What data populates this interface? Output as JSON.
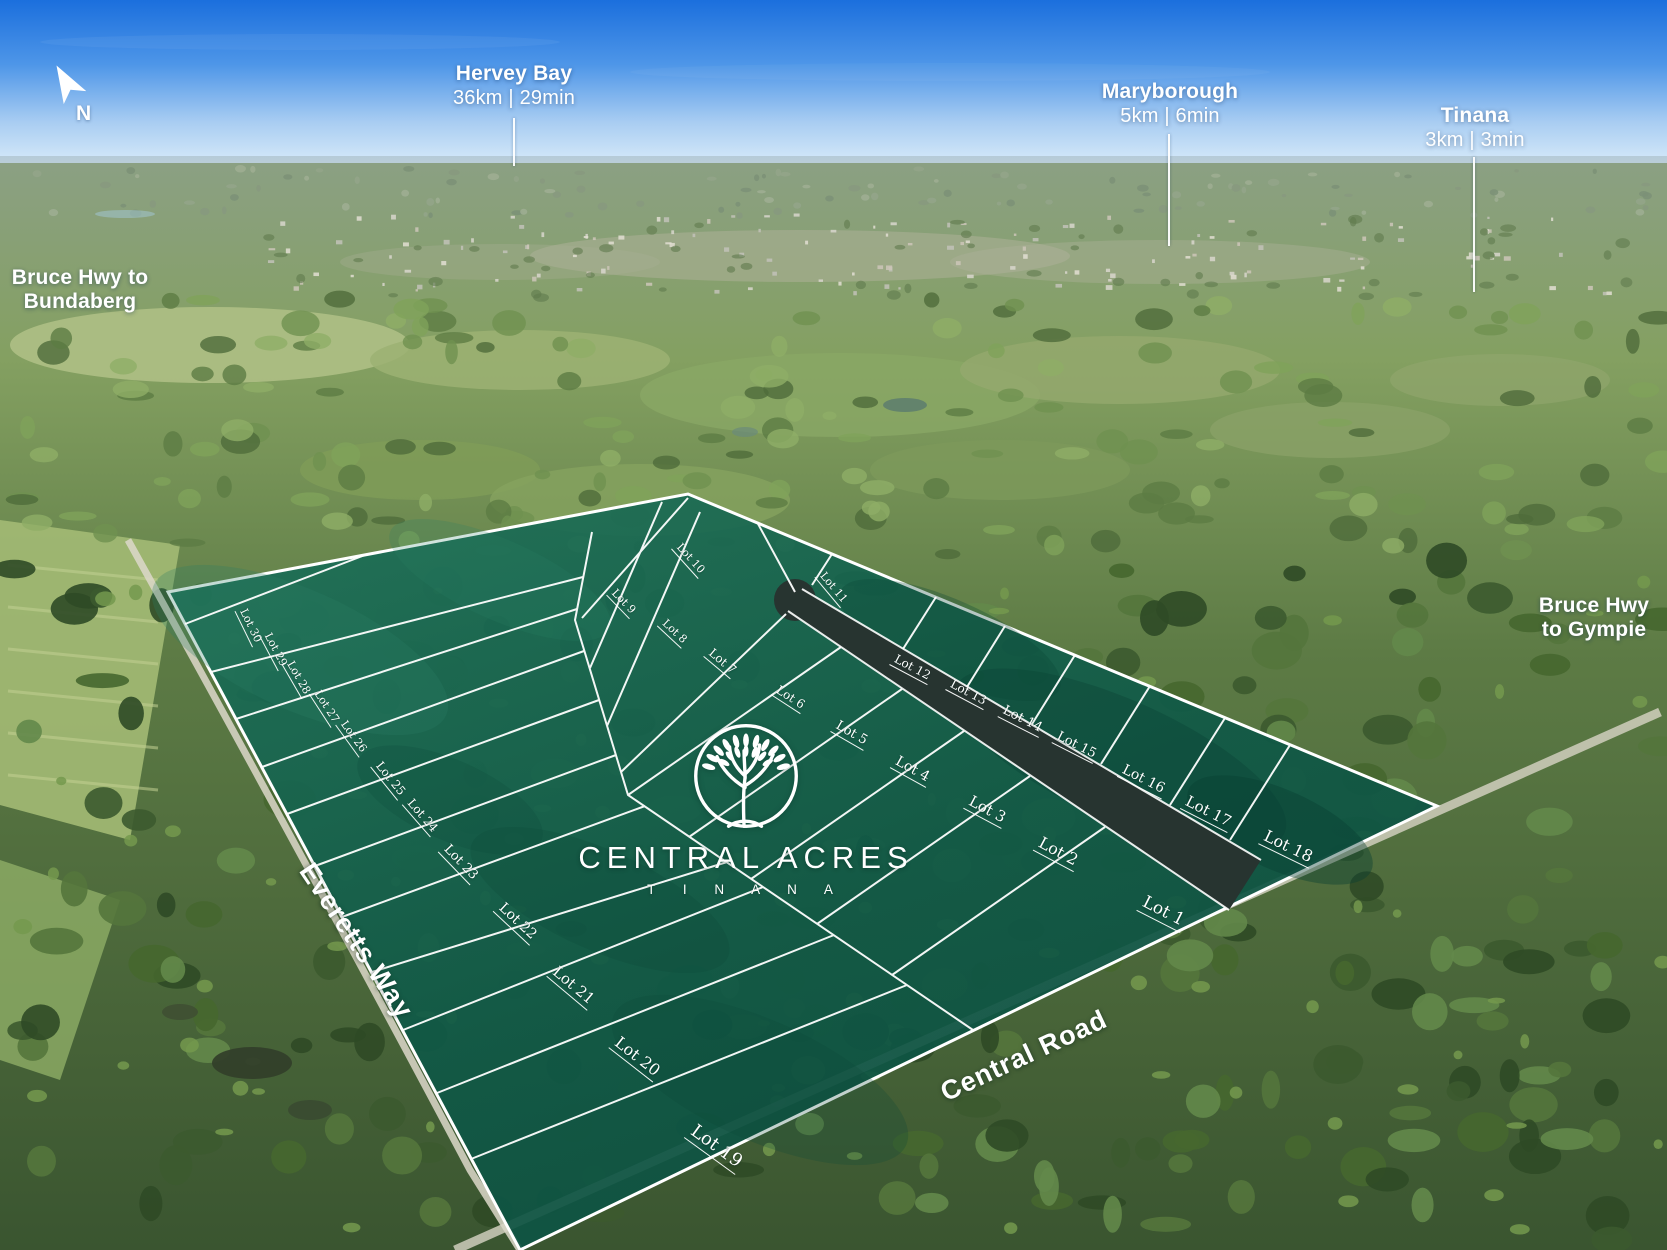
{
  "scene": {
    "name": "Central Acres Tinana aerial estate masterplan"
  },
  "compass": {
    "label": "N"
  },
  "callouts": [
    {
      "id": "hervey-bay",
      "x": 514,
      "y": 62,
      "lines": [
        {
          "t": "Hervey Bay",
          "b": true
        },
        {
          "t": "36km | 29min",
          "b": false
        }
      ],
      "leader": {
        "x": 513,
        "y1": 118,
        "y2": 166
      }
    },
    {
      "id": "maryborough",
      "x": 1170,
      "y": 80,
      "lines": [
        {
          "t": "Maryborough",
          "b": true
        },
        {
          "t": "5km | 6min",
          "b": false
        }
      ],
      "leader": {
        "x": 1168,
        "y1": 134,
        "y2": 246
      }
    },
    {
      "id": "tinana",
      "x": 1475,
      "y": 104,
      "lines": [
        {
          "t": "Tinana",
          "b": true
        },
        {
          "t": "3km | 3min",
          "b": false
        }
      ],
      "leader": {
        "x": 1473,
        "y1": 157,
        "y2": 292
      }
    },
    {
      "id": "bruce-hwy-bundaberg",
      "x": 80,
      "y": 266,
      "lines": [
        {
          "t": "Bruce Hwy to",
          "b": true
        },
        {
          "t": "Bundaberg",
          "b": true
        }
      ],
      "leader": null
    },
    {
      "id": "bruce-hwy-gympie",
      "x": 1594,
      "y": 594,
      "lines": [
        {
          "t": "Bruce Hwy",
          "b": true
        },
        {
          "t": "to Gympie",
          "b": true
        }
      ],
      "leader": null
    }
  ],
  "road_labels": [
    {
      "id": "everetts-way",
      "text": "Everetts Way",
      "x": 356,
      "y": 941,
      "rot": 56,
      "size": 27
    },
    {
      "id": "central-road",
      "text": "Central Road",
      "x": 1024,
      "y": 1056,
      "rot": -25,
      "size": 27
    }
  ],
  "logo": {
    "name": "CENTRAL ACRES",
    "locality": "T I N A N A"
  },
  "lots": [
    {
      "label": "Lot 30",
      "x": 250,
      "y": 626,
      "rot": 64,
      "s": 11
    },
    {
      "label": "Lot 29",
      "x": 275,
      "y": 650,
      "rot": 62,
      "s": 11
    },
    {
      "label": "Lot 28",
      "x": 298,
      "y": 678,
      "rot": 60,
      "s": 11
    },
    {
      "label": "Lot 27",
      "x": 326,
      "y": 707,
      "rot": 57,
      "s": 11
    },
    {
      "label": "Lot 26",
      "x": 353,
      "y": 737,
      "rot": 54,
      "s": 11
    },
    {
      "label": "Lot 25",
      "x": 390,
      "y": 779,
      "rot": 51,
      "s": 12
    },
    {
      "label": "Lot 24",
      "x": 422,
      "y": 816,
      "rot": 49,
      "s": 12
    },
    {
      "label": "Lot 23",
      "x": 460,
      "y": 863,
      "rot": 46,
      "s": 13
    },
    {
      "label": "Lot 22",
      "x": 517,
      "y": 922,
      "rot": 43,
      "s": 14
    },
    {
      "label": "Lot 21",
      "x": 573,
      "y": 986,
      "rot": 40,
      "s": 15
    },
    {
      "label": "Lot 20",
      "x": 637,
      "y": 1057,
      "rot": 38,
      "s": 16
    },
    {
      "label": "Lot 19",
      "x": 716,
      "y": 1147,
      "rot": 36,
      "s": 18
    },
    {
      "label": "Lot 10",
      "x": 690,
      "y": 559,
      "rot": 48,
      "s": 11
    },
    {
      "label": "Lot 11",
      "x": 833,
      "y": 588,
      "rot": 50,
      "s": 11
    },
    {
      "label": "Lot 9",
      "x": 623,
      "y": 602,
      "rot": 46,
      "s": 11
    },
    {
      "label": "Lot 8",
      "x": 674,
      "y": 632,
      "rot": 43,
      "s": 11
    },
    {
      "label": "Lot 7",
      "x": 722,
      "y": 662,
      "rot": 40,
      "s": 12
    },
    {
      "label": "Lot 6",
      "x": 790,
      "y": 698,
      "rot": 33,
      "s": 12
    },
    {
      "label": "Lot 5",
      "x": 851,
      "y": 734,
      "rot": 30,
      "s": 13
    },
    {
      "label": "Lot 4",
      "x": 912,
      "y": 770,
      "rot": 29,
      "s": 14
    },
    {
      "label": "Lot 3",
      "x": 987,
      "y": 810,
      "rot": 28,
      "s": 15
    },
    {
      "label": "Lot 2",
      "x": 1058,
      "y": 852,
      "rot": 28,
      "s": 16
    },
    {
      "label": "Lot 1",
      "x": 1163,
      "y": 912,
      "rot": 27,
      "s": 17
    },
    {
      "label": "Lot 12",
      "x": 912,
      "y": 668,
      "rot": 28,
      "s": 12
    },
    {
      "label": "Lot 13",
      "x": 968,
      "y": 693,
      "rot": 28,
      "s": 12
    },
    {
      "label": "Lot 14",
      "x": 1022,
      "y": 720,
      "rot": 27,
      "s": 13
    },
    {
      "label": "Lot 15",
      "x": 1076,
      "y": 746,
      "rot": 27,
      "s": 13
    },
    {
      "label": "Lot 16",
      "x": 1143,
      "y": 780,
      "rot": 27,
      "s": 14
    },
    {
      "label": "Lot 17",
      "x": 1208,
      "y": 812,
      "rot": 27,
      "s": 15
    },
    {
      "label": "Lot 18",
      "x": 1288,
      "y": 847,
      "rot": 26,
      "s": 16
    }
  ],
  "palette": {
    "estate_green": "#12614d",
    "line_white": "#ffffff",
    "road_dark": "#273430",
    "sky_blue": "#1b6fdd"
  }
}
